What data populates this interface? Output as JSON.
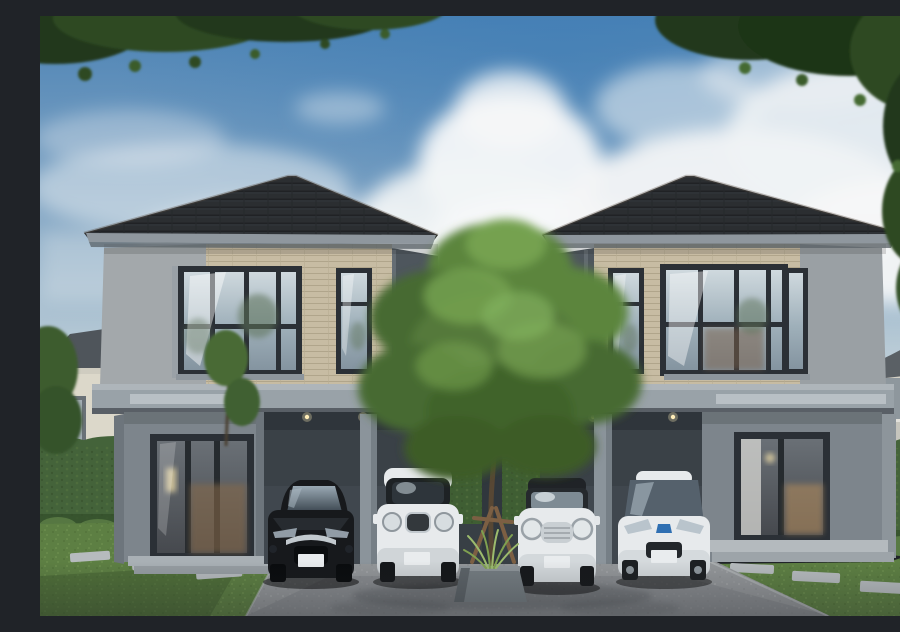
{
  "scene": {
    "title": "Architectural rendering of twin two-storey houses with carports",
    "description": "Two symmetric modern grey duplex houses with dark hipped tile roofs and beige tiled upper facades. Four cars are parked under the carports: a black sedan, a white compact crossover, a white mini convertible and a white hybrid hatchback. A young staked tree in a grey planter stands between the driveways. Lawns with stepping stones, trimmed hedges and neighbouring houses sit under a blue sky with cumulus clouds and overhanging foliage in the top corners.",
    "setting": "daytime, residential estate"
  },
  "colors": {
    "sky_top": "#4c83b5",
    "sky_mid": "#7ba1c2",
    "sky_horizon": "#d8dfe3",
    "cloud": "#f4f6f7",
    "roof": "#2b2e32",
    "fascia": "#8f979e",
    "tile": "#c7bca3",
    "wall_side": "#a3a8ab",
    "wall_inner": "#4e565d",
    "slab": "#99a2a8",
    "wall_ground": "#7d858c",
    "carport": "#3a4147",
    "pillar": "#8b949b",
    "frame": "#2b3036",
    "glass_sky": "#c3cfd6",
    "interior_warm": "#b3895c",
    "grass": "#5d7f43",
    "hedge": "#44633a",
    "drive": "#939699",
    "stone": "#b6bbbe",
    "trunk": "#574734",
    "stake": "#7c5f43",
    "canopy_mid": "#5c853e",
    "planter": "#747c81",
    "car_black": "#17191c",
    "car_white": "#e7eaec",
    "windshield": "#46525c",
    "chrome": "#c2c9ce",
    "plate": "#e9ecee",
    "bg_wall": "#dcd8ca",
    "bg_roof": "#4f555b",
    "railing": "#e3e2dc",
    "foliage_dark": "#24391d"
  },
  "objects": {
    "sky": {
      "label": "blue sky with cumulus clouds"
    },
    "left_house": {
      "label": "left two-storey house",
      "features": [
        "dark hipped tile roof",
        "beige tiled upper facade",
        "corner window",
        "tall narrow window",
        "grey ground floor",
        "sliding glass window with warm interior",
        "double carport with downlights"
      ]
    },
    "right_house": {
      "label": "right two-storey house (mirrored twin)",
      "features": [
        "dark hipped tile roof",
        "beige tiled upper facade",
        "large upper window",
        "tall narrow window",
        "grey ground floor",
        "sliding glass window with warm interior",
        "double carport with downlights"
      ]
    },
    "cars": [
      {
        "label": "black sedan",
        "position": "left carport, left bay"
      },
      {
        "label": "white compact crossover",
        "position": "left carport, right bay"
      },
      {
        "label": "white mini convertible",
        "position": "right carport, left bay"
      },
      {
        "label": "white hybrid hatchback",
        "position": "right carport, right bay"
      }
    ],
    "tree": {
      "label": "young tree with support stakes in a grey planter"
    },
    "landscape": {
      "left": "neighbouring house, trimmed hedge, lawn with stepping stones",
      "right": "neighbouring house with balcony, trimmed hedge, lawn with stepping stones"
    },
    "driveway": {
      "label": "concrete driveway"
    }
  }
}
